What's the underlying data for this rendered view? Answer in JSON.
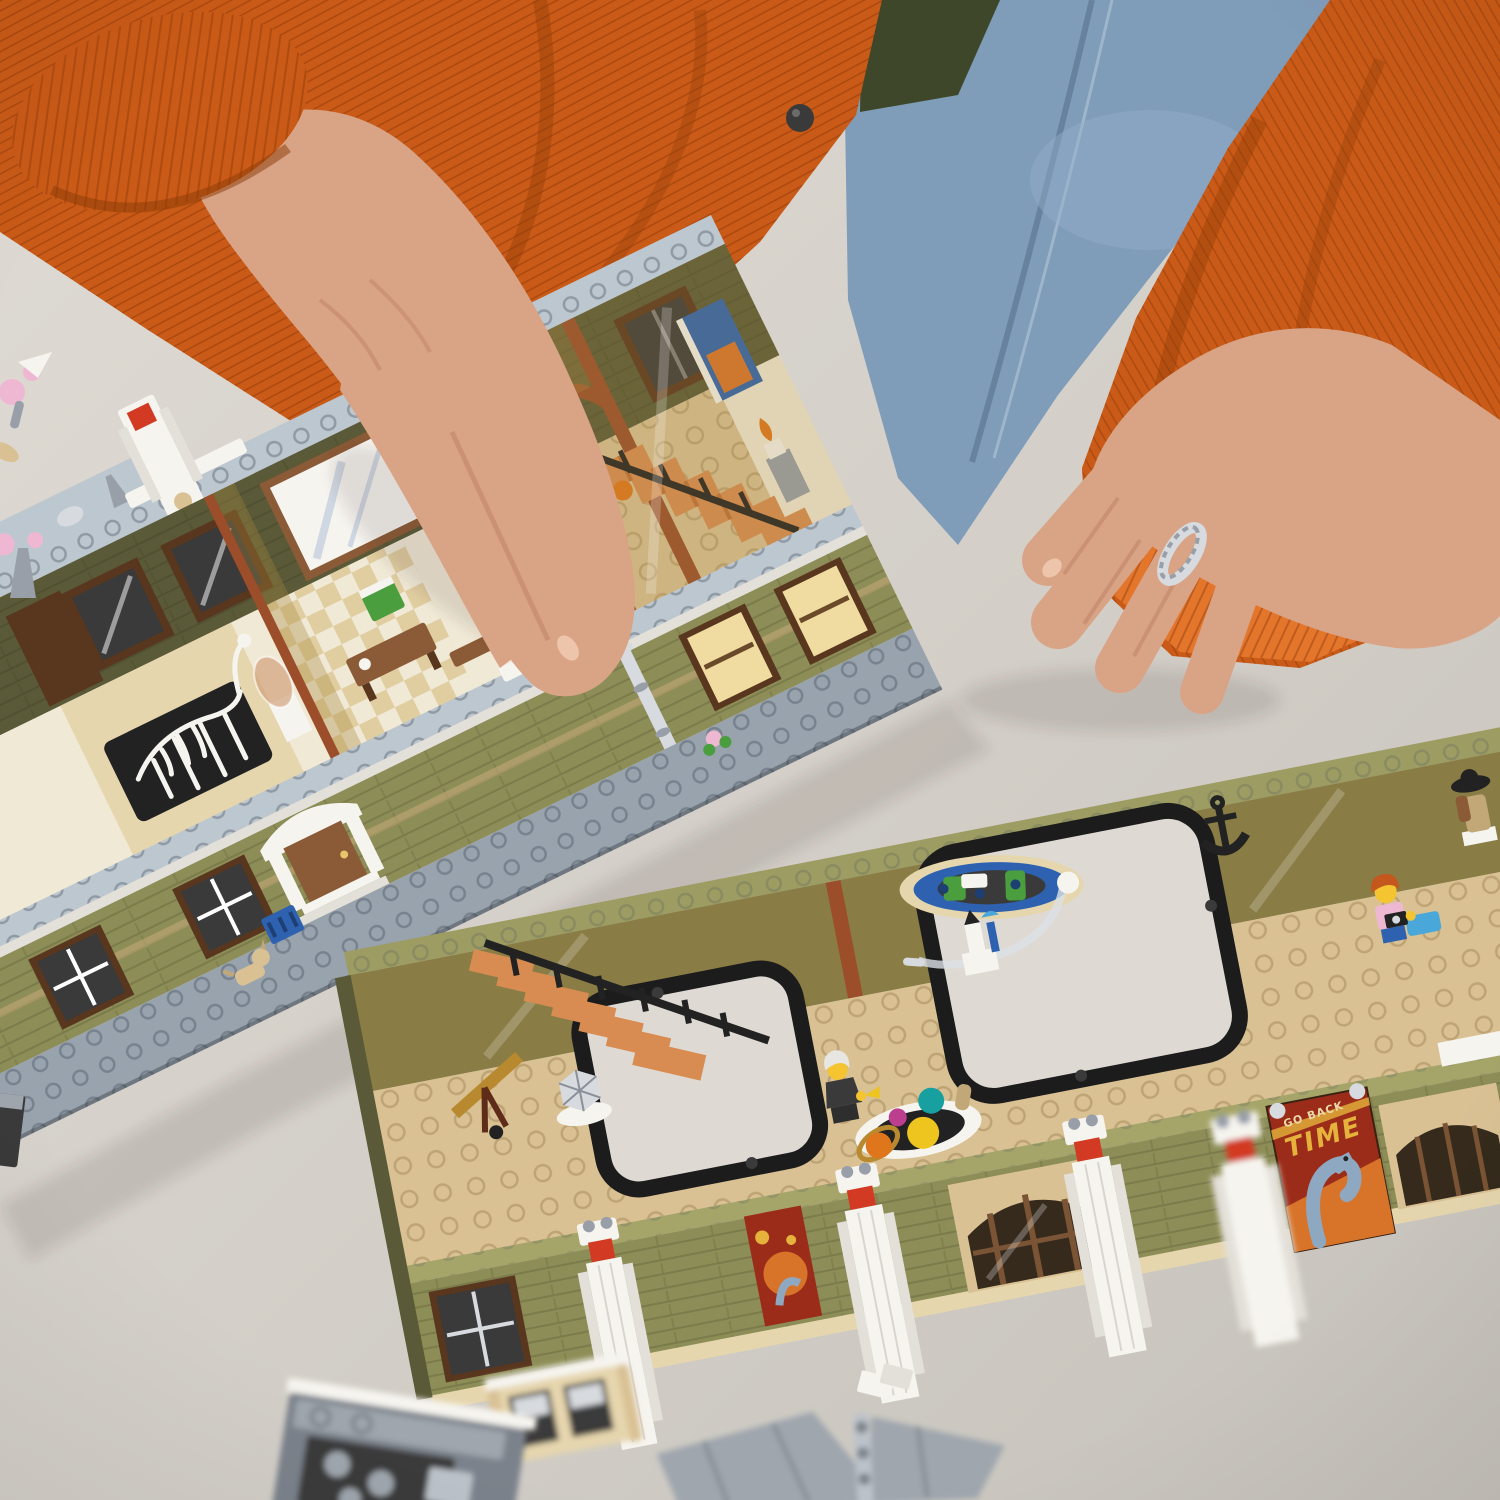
{
  "scene": {
    "description": "Photograph from above: a person in an orange corduroy jacket and jeans sits at a light gray table assembling a LEGO museum modular building. Two open-top floor sections sit diagonally on the table: an upper olive-green museum floor with a white dinosaur skeleton, staircase and minifigure, and a lower floor with orange stairs, a solar-system exhibit, hanging fish exhibit, rocket, anchor and minifigures. White pillars with red tiles, a dinosaur poster, and loose gray roof pieces lie around.",
    "poster": {
      "top": "GO BACK",
      "main": "TIME"
    },
    "objects": [
      "left-hand",
      "right-hand",
      "braided-ring",
      "orange-corduroy-jacket",
      "jeans",
      "green-shirt",
      "upper-museum-floor-section",
      "dinosaur-skeleton-exhibit",
      "bell-jar-exhibit",
      "staircase-minifigure",
      "orange-staircase",
      "entrance-portico",
      "drain-pipe",
      "dog-figure",
      "blue-crate",
      "pink-flower",
      "lower-museum-floor-section",
      "solar-system-exhibit",
      "scientist-minifigure",
      "camera-visitor-minifigure",
      "mannequin-with-hat",
      "fish-fossil-exhibit",
      "rocket-exhibit",
      "anchor-exhibit",
      "telescope",
      "geodesic-ball",
      "white-pillar-red-tile",
      "dinosaur-time-poster",
      "bay-window",
      "hinged-roof-piece",
      "gray-sub-assembly",
      "cherry-blossom-pieces",
      "pigeon-figure",
      "table",
      "floor-background"
    ]
  },
  "palette": {
    "table": "#d3cfc8",
    "tableLight": "#dedad3",
    "tableDark": "#c5c1ba",
    "floorBeige": "#e9dfca",
    "jeans": "#7f9cb9",
    "jeansLight": "#94afc9",
    "jeansDark": "#66829d",
    "shirtGreen": "#3e4729",
    "jacket": "#c95a17",
    "jacketDark": "#a84a0d",
    "jacketDeep": "#8a3a06",
    "jacketLight": "#e4762c",
    "skin": "#d9a385",
    "skinShadow": "#bd8164",
    "skinLight": "#edc5aa",
    "silver": "#d7dade",
    "silverDark": "#989fa9",
    "olive": "#8d8d57",
    "oliveLight": "#9d9d63",
    "oliveDark": "#74744a",
    "oliveDeep": "#5a5a38",
    "oliveTop": "#a5a56a",
    "ledge": "#bdc7cf",
    "ledgeShadow": "#a3aeb8",
    "basePlate": "#98a3ad",
    "basePlateDark": "#85909a",
    "tanFloor": "#d9c194",
    "tanDark": "#c2a877",
    "tanLight": "#e6d6ae",
    "cream": "#f0e9d6",
    "brown": "#8b5a36",
    "brownDark": "#59361e",
    "rust": "#9c4e2b",
    "amber": "#a9893f",
    "white": "#f6f4ef",
    "whiteDim": "#e3e0d9",
    "black": "#222222",
    "charcoal": "#3a3a3a",
    "red": "#d23a23",
    "stair": "#d88c51",
    "stairDark": "#bf7038",
    "grayPiece": "#9fa6ad",
    "grayPieceDark": "#7b828b",
    "grayPieceLight": "#bcc2c9",
    "minifigYellow": "#f5c431",
    "hairBrown": "#5c3a1c",
    "hairOrange": "#c3571d",
    "hairWhite": "#e8e6e0",
    "pink": "#efb8d2",
    "green": "#4a9e3e",
    "greenDark": "#2e7d32",
    "blue": "#2e62b0",
    "blueLight": "#49a8d9",
    "tealBall": "#189f9f",
    "magentaBall": "#bc3e8e",
    "sunYellow": "#eec41f",
    "orangeBall": "#e0761c",
    "goldRing": "#b8892f",
    "posterRed": "#9c2c1a",
    "posterOrange": "#d8742a",
    "posterYellow": "#e5b33c",
    "posterBlue": "#8fa8c2",
    "posterCream": "#e9d9a8",
    "warmWindow": "#f0dca0",
    "shadow": "rgba(60,55,45,0.13)"
  }
}
